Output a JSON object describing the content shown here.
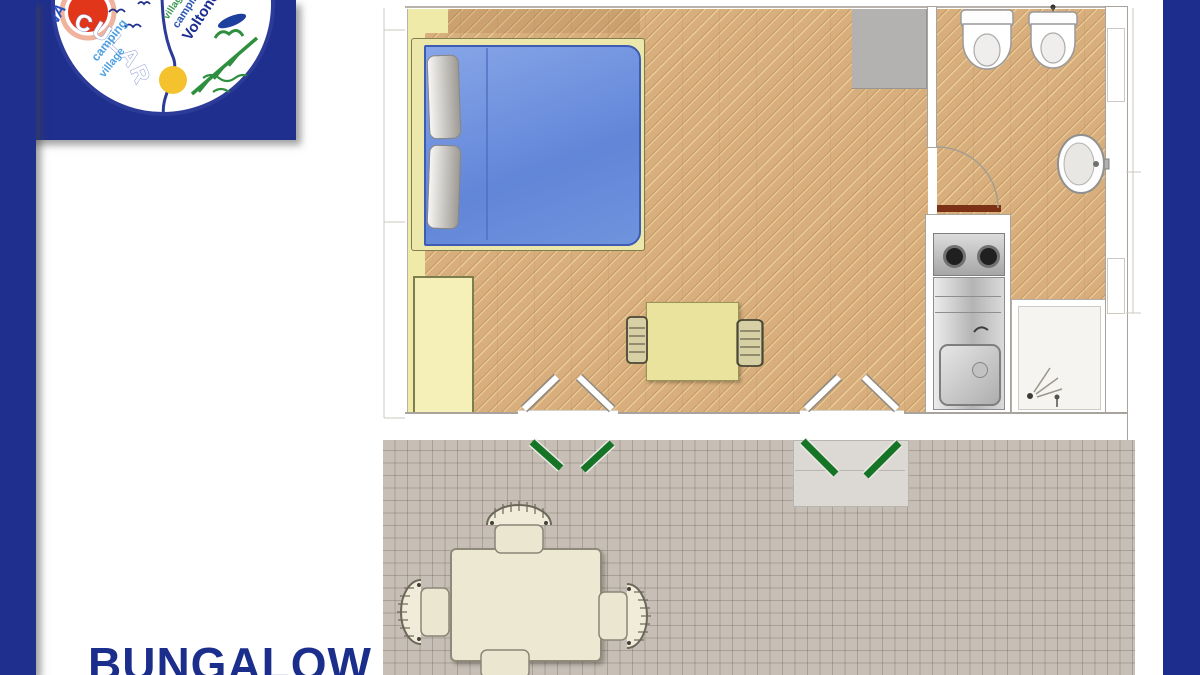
{
  "brand": {
    "left_logo": {
      "rim_text": "NA",
      "arc_text": "CULARA",
      "tagline_line1": "camping",
      "tagline_line2": "village"
    },
    "right_logo": {
      "line1": "village",
      "line2": "camping",
      "line3": "Voltoncino"
    }
  },
  "title": {
    "label": "BUNGALOW"
  },
  "colors": {
    "frame_navy": "#1f2f8d",
    "right_band_navy": "#1c2d8e",
    "floor_parquet_tan": "#d7ae7c",
    "wall_yellow": "#efeaa8",
    "terrace_gray": "#c7bfb6",
    "bed_blue": "#7397de",
    "bed_frame_cream": "#ece8ab",
    "shutter_green": "#167427",
    "bathroom_door_brown": "#7a3116",
    "title_navy": "#1c2e8c",
    "logo_red_sun": "#e13619",
    "logo_yellow_sun": "#f3c22d",
    "logo_green": "#2e8f3e"
  },
  "floor_plan": {
    "rooms": [
      {
        "name": "main-room",
        "floor": "diagonal parquet"
      },
      {
        "name": "bathroom",
        "floor": "diagonal parquet"
      },
      {
        "name": "terrace",
        "floor": "gray tile grid"
      }
    ],
    "furniture_and_fixtures": [
      "double-bed",
      "pillows",
      "wardrobe",
      "gray-cabinet",
      "dining-table",
      "indoor-chairs",
      "kitchenette-stove-2-burners",
      "kitchenette-steel-sink",
      "shower-tray",
      "toilet",
      "bidet",
      "washbasin",
      "outdoor-table",
      "outdoor-chairs",
      "french-door-left",
      "french-door-right",
      "green-shutters",
      "bathroom-door-with-swing-arc",
      "entry-step"
    ]
  }
}
